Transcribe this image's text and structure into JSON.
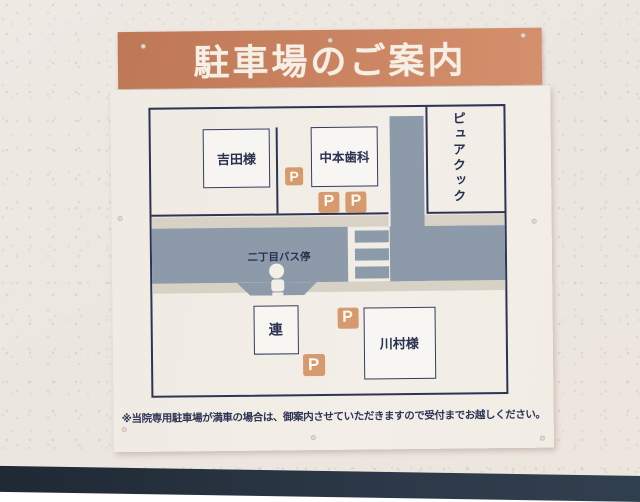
{
  "sign": {
    "title": "駐車場のご案内",
    "note": "※当院専用駐車場が満車の場合は、御案内させていただきますので受付までお越しください。",
    "map": {
      "buildings": {
        "yoshida": "吉田様",
        "nakamoto": "中本歯科",
        "purecook": "ピュアクック",
        "ren": "連",
        "kawamura": "川村様"
      },
      "bus_stop": "二丁目バス停",
      "parking_label": "P"
    },
    "colors": {
      "header_bg": "#c98260",
      "board_bg": "#f2eee7",
      "line_navy": "#2e3456",
      "road_gray": "#8c9aa9",
      "sidewalk_beige": "#d8d2c6",
      "parking_orange": "#d69a6e",
      "floor_dark": "#2c3847"
    }
  }
}
